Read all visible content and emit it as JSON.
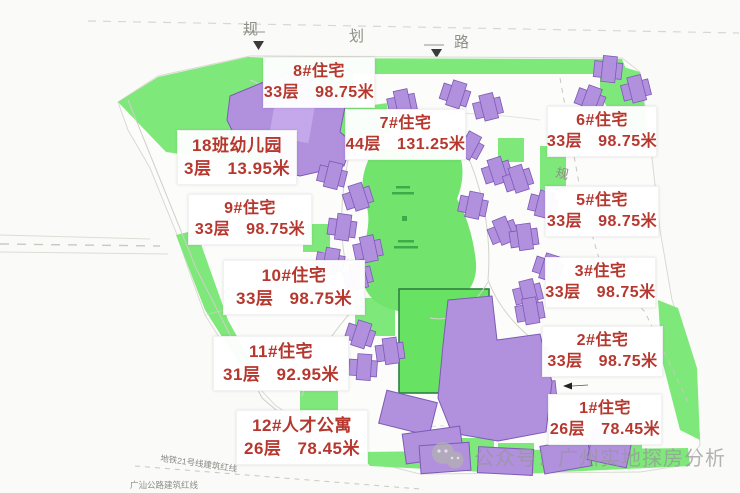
{
  "roads": {
    "top_label_chars": [
      "规",
      "划",
      "路"
    ],
    "right_label_char": "规"
  },
  "boundary_notes": {
    "metro": "地铁21号线建筑红线",
    "highway": "广汕公路建筑红线"
  },
  "buildings": [
    {
      "name": "8#住宅",
      "floors": "33层",
      "height": "98.75米"
    },
    {
      "name": "7#住宅",
      "floors": "44层",
      "height": "131.25米"
    },
    {
      "name": "6#住宅",
      "floors": "33层",
      "height": "98.75米"
    },
    {
      "name": "18班幼儿园",
      "floors": "3层",
      "height": "13.95米"
    },
    {
      "name": "9#住宅",
      "floors": "33层",
      "height": "98.75米"
    },
    {
      "name": "5#住宅",
      "floors": "33层",
      "height": "98.75米"
    },
    {
      "name": "10#住宅",
      "floors": "33层",
      "height": "98.75米"
    },
    {
      "name": "3#住宅",
      "floors": "33层",
      "height": "98.75米"
    },
    {
      "name": "11#住宅",
      "floors": "31层",
      "height": "92.95米"
    },
    {
      "name": "2#住宅",
      "floors": "33层",
      "height": "98.75米"
    },
    {
      "name": "12#人才公寓",
      "floors": "26层",
      "height": "78.45米"
    },
    {
      "name": "1#住宅",
      "floors": "26层",
      "height": "78.45米"
    }
  ],
  "watermark": {
    "text": "公众号：广州实地探房分析"
  },
  "colors": {
    "label_text": "#b6372e",
    "building_fill": "#b190de",
    "building_stroke": "#7d5ab6",
    "site_green": "#7fe87a",
    "garden_green": "#72e46e",
    "field_green": "#68e263",
    "road_text": "#8f8f88"
  }
}
